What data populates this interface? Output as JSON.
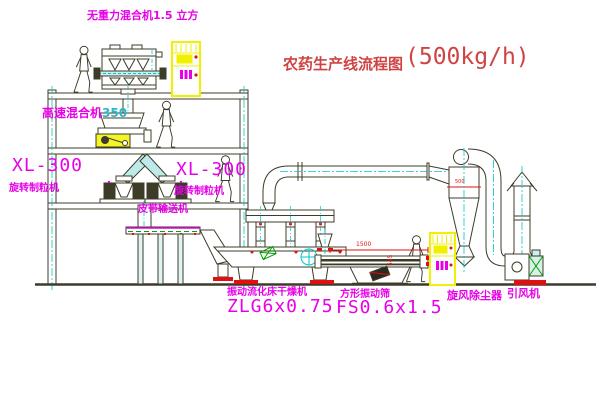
{
  "title": {
    "text": "农药生产线流程图",
    "capacity": "(500kg/h)"
  },
  "labels": {
    "gravity_mixer": "无重力混合机1.5 立方",
    "high_speed_mixer_name": "高速混合机",
    "high_speed_mixer_size": "350",
    "granulator_left": {
      "model": "XL-300",
      "name": "旋转制粒机"
    },
    "granulator_right": {
      "model": "XL-300",
      "name": "旋转制粒机"
    },
    "belt_conveyor": "皮带输送机",
    "dryer": {
      "name": "振动流化床干燥机",
      "model": "ZLG6x0.75"
    },
    "sieve": {
      "name": "方形振动筛",
      "model": "FS0.6x1.5"
    },
    "cyclone": "旋风除尘器",
    "fan": "引风机"
  },
  "dimensions": {
    "sieve_length": "1500",
    "sieve_height": "545",
    "cyclone_dia": "500"
  },
  "colors": {
    "label_magenta": "#e800e8",
    "title_red": "#d04343",
    "line_ink": "#3c3c28",
    "accent_cyan": "#00c8c8",
    "cabinet_yellow": "#f0f000",
    "alert_red": "#e01010",
    "machine_green": "#00a000"
  }
}
